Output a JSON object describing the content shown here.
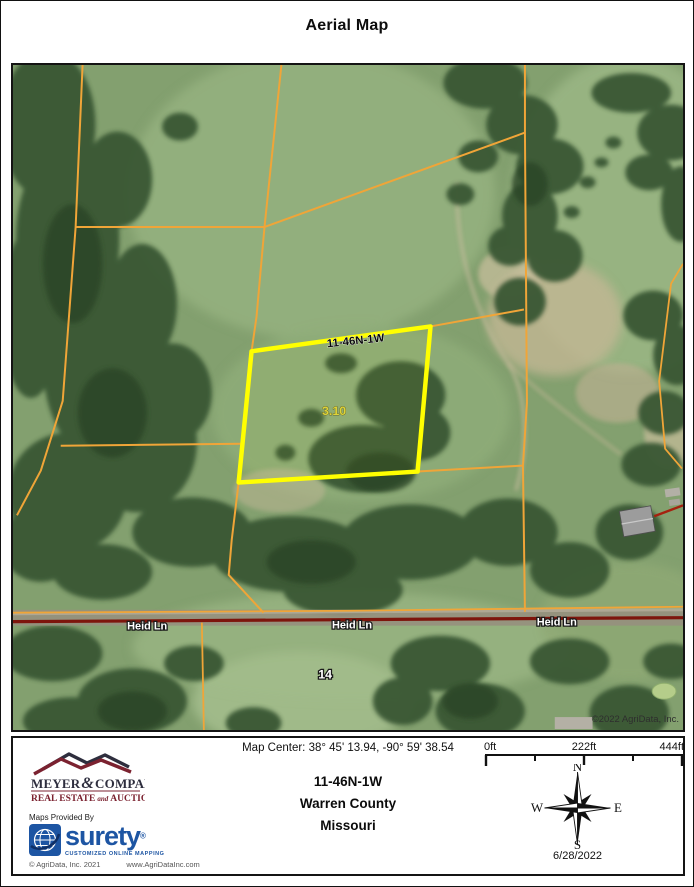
{
  "title": "Aerial Map",
  "map": {
    "parcel_label": "11-46N-1W",
    "acreage": "3.10",
    "road_name_1": "Heid Ln",
    "road_name_2": "Heid Ln",
    "road_name_3": "Heid Ln",
    "section_number": "14",
    "copyright": "©2022 AgriData, Inc."
  },
  "footer": {
    "map_center": "Map Center: 38° 45' 13.94,  -90° 59' 38.54",
    "scale_start": "0ft",
    "scale_mid": "222ft",
    "scale_end": "444ft",
    "township": "11-46N-1W",
    "county": "Warren County",
    "state": "Missouri",
    "date": "6/28/2022",
    "compass_n": "N",
    "compass_e": "E",
    "compass_s": "S",
    "compass_w": "W",
    "logo": {
      "name_left": "MEYER",
      "ampersand": "&",
      "name_right": "COMPANY",
      "tagline_left": "REAL ESTATE",
      "tagline_and": "and",
      "tagline_right": "AUCTIONS"
    },
    "provider": {
      "label": "Maps Provided By",
      "brand": "surety",
      "registered": "®",
      "tagline": "CUSTOMIZED ONLINE MAPPING",
      "copyright": "© AgriData, Inc. 2021",
      "website": "www.AgriDataInc.com"
    }
  },
  "colors": {
    "parcel_line_orange": "#f0a538",
    "highlight_parcel_yellow": "#ffff00",
    "road_dark_red": "#7d150c",
    "surety_blue": "#1d55a3",
    "logo_maroon": "#7b2230",
    "field_green": "#83a06f",
    "tree_green": "#3a5836"
  }
}
